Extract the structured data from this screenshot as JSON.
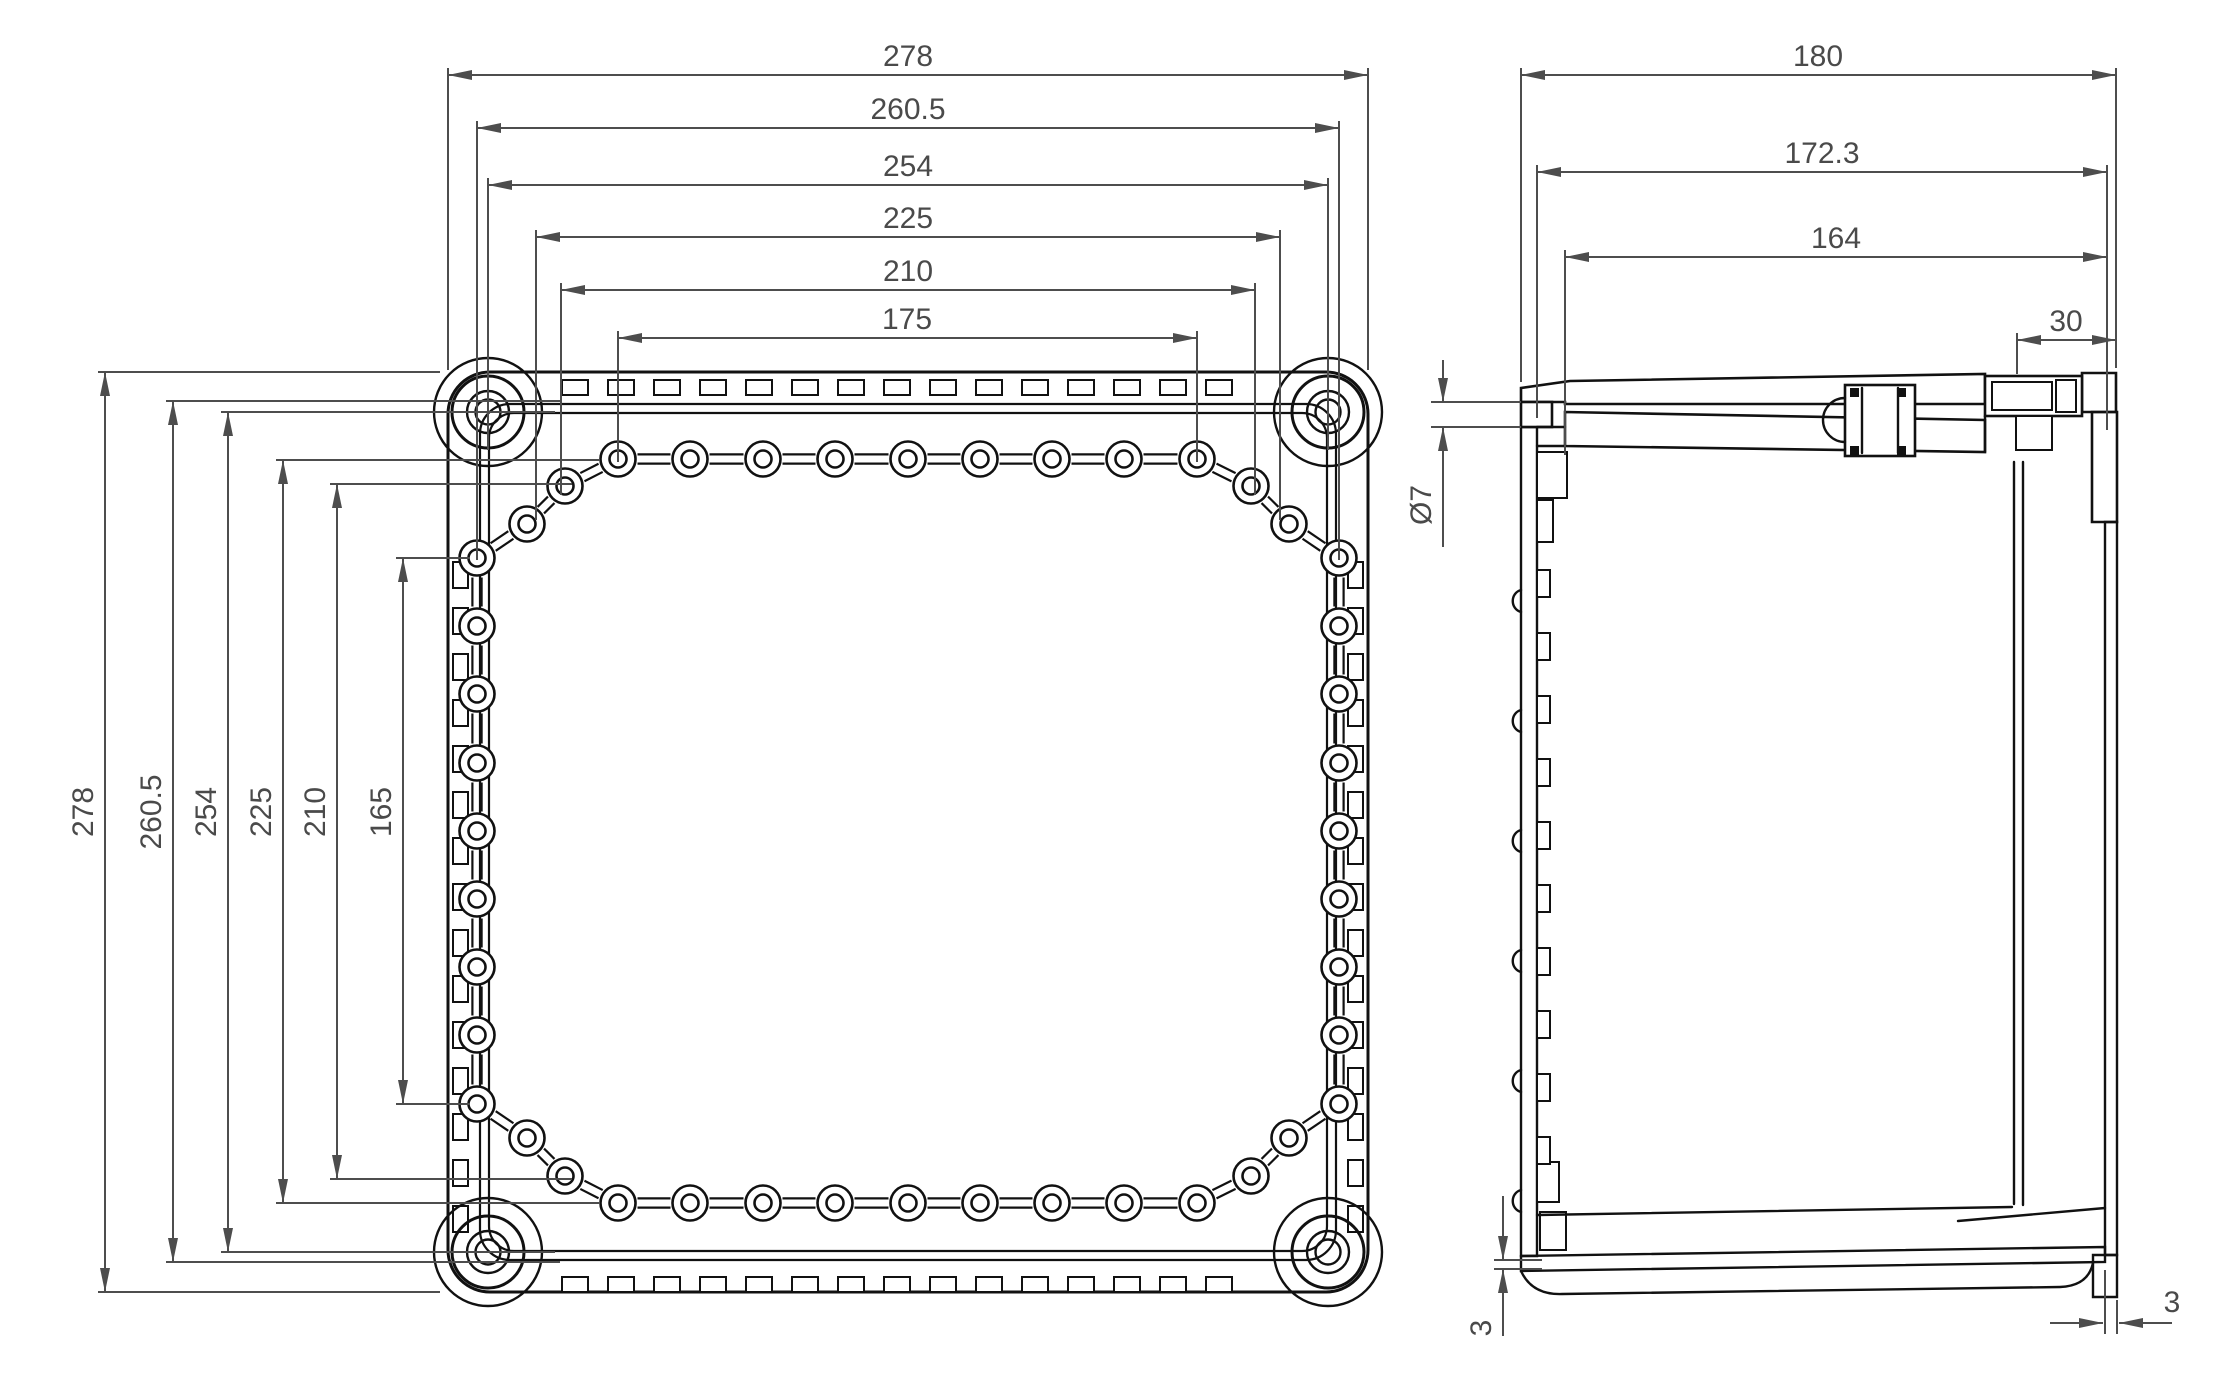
{
  "drawing": {
    "type": "technical-dimension-drawing",
    "views": {
      "plan": "enclosure front view",
      "side": "enclosure section view"
    }
  },
  "labels": {
    "plan_w": [
      "278",
      "260.5",
      "254",
      "225",
      "210",
      "175"
    ],
    "plan_h": [
      "278",
      "260.5",
      "254",
      "225",
      "210",
      "165"
    ],
    "side_w": [
      "180",
      "172.3",
      "164",
      "30"
    ],
    "hole_d": "Ø7",
    "thickness_bottom": "3",
    "thickness_wall": "3"
  }
}
